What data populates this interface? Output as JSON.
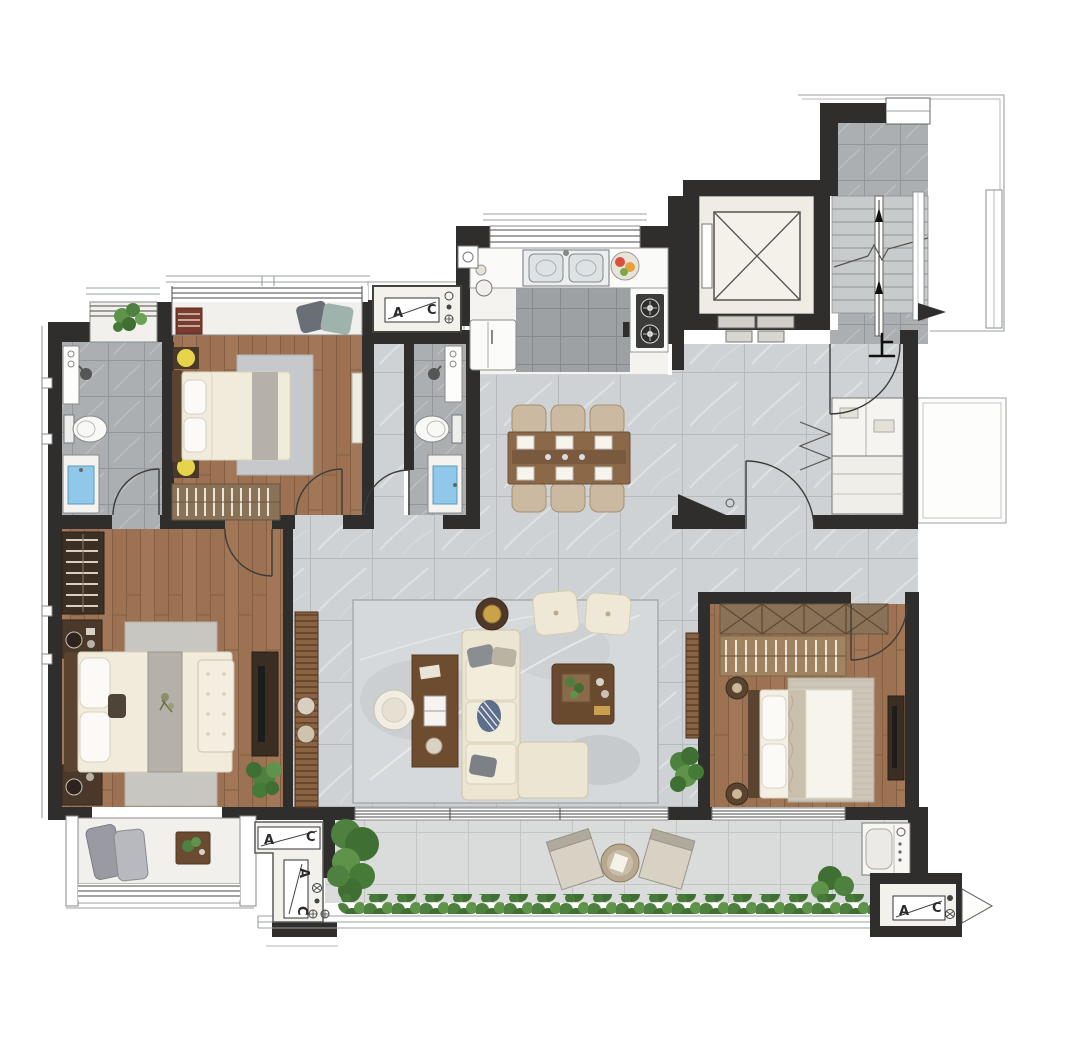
{
  "text": {
    "stairs_up_label": "上",
    "ac_plates": [
      {
        "id": "north-platform",
        "letter_left": "A",
        "letter_right": "C"
      },
      {
        "id": "southwest-horizontal",
        "letter_left": "A",
        "letter_right": "C"
      },
      {
        "id": "southwest-vertical",
        "letter_left": "A",
        "letter_right": "C"
      },
      {
        "id": "southeast-platform",
        "letter_left": "A",
        "letter_right": "C"
      }
    ]
  },
  "colors": {
    "wall": "#2f2e2c",
    "wood": "#9c7252",
    "woodLine": "#845f43",
    "marble": "#ced2d4",
    "marbleLine": "#b6babc",
    "bathTile": "#abafb2",
    "bathTileLine": "#93979a",
    "kitchenTile": "#9da1a4",
    "kitchenTileLine": "#868a8d",
    "balconyTile": "#d9dcda",
    "balconyTileLine": "#c2c5c2",
    "water": "#8fc8e8",
    "plant": "#4e8040",
    "plantDark": "#3f6f33",
    "plantLight": "#5f9349",
    "lamp": "#e8d44a",
    "cream": "#ece5d2",
    "platform": "#f2f1ec",
    "rug": "#d6d9db",
    "furnitureDark": "#4a382a",
    "furnitureWood": "#6e4c30"
  }
}
